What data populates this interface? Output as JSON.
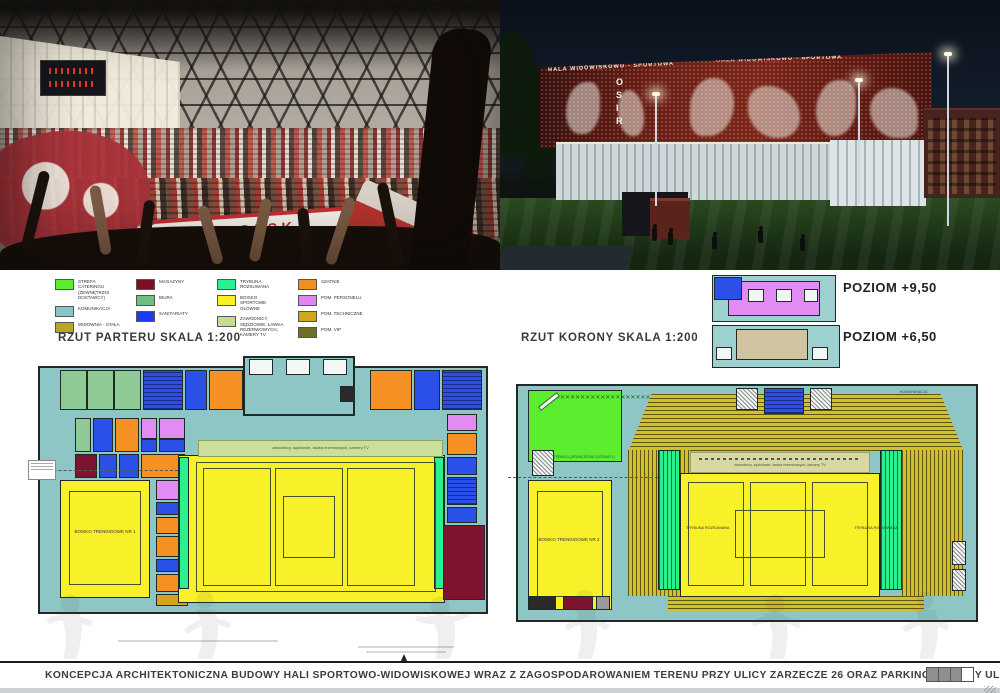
{
  "board": {
    "number": "616161",
    "caption": "KONCEPCJA ARCHITEKTONICZNA BUDOWY HALI SPORTOWO-WIDOWISKOWEJ WRAZ Z ZAGOSPODAROWANIEM TERENU PRZY ULICY ZARZECZE 26 ORAZ PARKINGIEM PRZY UL. GRUNWALDZKIEJ W SUWAŁKACH"
  },
  "photo": {
    "scarf_text": "POLSKA"
  },
  "render": {
    "facade_text_left": "HALA WIDOWISKOWO - SPORTOWA",
    "facade_text_right": "HALA WIDOWISKOWO - SPORTOWA",
    "vertical_sign": "OSIR"
  },
  "legend": {
    "columns": [
      {
        "items": [
          {
            "color": "#5ced2f",
            "label": "STREFA CATERINGU (ZEWNĘTRZNI DOSTAWCY)"
          },
          {
            "color": "#86c6c6",
            "label": "KOMUNIKACJA"
          },
          {
            "color": "#b9a81f",
            "label": "WIDOWNIA - STAŁA"
          }
        ]
      },
      {
        "items": [
          {
            "color": "#7c0f26",
            "label": "MAGAZYNY"
          },
          {
            "color": "#6fbf85",
            "label": "BIURA"
          },
          {
            "color": "#1f3af0",
            "label": "SANITARIATY"
          }
        ]
      },
      {
        "items": [
          {
            "color": "#2bf08d",
            "label": "TRYBUNA ROZSUWANA"
          },
          {
            "color": "#f8f022",
            "label": "BOISKO SPORTOWE GŁÓWNE"
          },
          {
            "color": "#c8dc8f",
            "label": "ZAWODNICY, SĘDZIOWIE, ŁAWKA REZERWOWYCH, KAMERY TV"
          }
        ]
      },
      {
        "items": [
          {
            "color": "#f2901f",
            "label": "SZATNIE"
          },
          {
            "color": "#dd85f0",
            "label": "POM. PERSONELU"
          },
          {
            "color": "#d2a51a",
            "label": "POM. TECHNICZNE"
          },
          {
            "color": "#6e6e24",
            "label": "POM. VIP"
          }
        ]
      }
    ]
  },
  "plans": {
    "left_title": "RZUT PARTERU SKALA 1:200",
    "right_title": "RZUT KORONY SKALA 1:200",
    "level_upper": "POZIOM +9,50",
    "level_lower": "POZIOM +6,50",
    "left": {
      "training_court": "BOISKO TRENINGOWE NR 1",
      "band_text": "zawodnicy, sędziowie, ławka rezerwowych, kamery TV"
    },
    "right": {
      "training_court": "BOISKO TRENINGOWE NR 2",
      "catering": "STREFA CATERINGU (ZEWNĘTRZNI DOSTAWCY)",
      "stand_left": "TRYBUNA ROZSUWANA",
      "stand_right": "TRYBUNA ROZSUWANA",
      "band_text": "zawodnicy, sędziowie, ławka rezerwowych, kamery TV",
      "komunikacja": "KOMUNIKACJA"
    }
  }
}
